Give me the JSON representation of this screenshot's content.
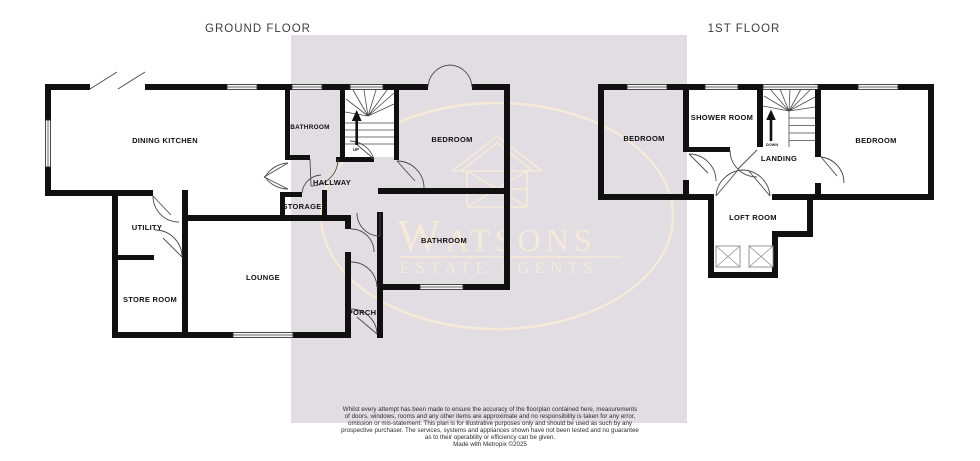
{
  "meta": {
    "wall_color": "#101010",
    "panel_color": "#e2dde2",
    "watermark_color": "#f5ead9",
    "background_color": "#ffffff"
  },
  "watermark": {
    "brand": "Watsons",
    "tagline": "ESTATE AGENTS"
  },
  "floors": {
    "ground": {
      "title": "GROUND FLOOR",
      "dining_kitchen": "DINING KITCHEN",
      "bathroom_top": "BATHROOM",
      "bedroom": "BEDROOM",
      "hallway": "HALLWAY",
      "storage": "STORAGE",
      "utility": "UTILITY",
      "lounge": "LOUNGE",
      "store_room": "STORE ROOM",
      "bathroom_bottom": "BATHROOM",
      "porch": "PORCH",
      "stair_label": "UP"
    },
    "first": {
      "title": "1ST FLOOR",
      "bedroom_left": "BEDROOM",
      "shower_room": "SHOWER ROOM",
      "landing": "LANDING",
      "bedroom_right": "BEDROOM",
      "loft_room": "LOFT ROOM",
      "stair_label": "DOWN"
    }
  },
  "footer": {
    "lines": [
      "Whilst every attempt has been made to ensure the accuracy of the floorplan contained here, measurements",
      "of doors, windows, rooms and any other items are approximate and no responsibility is taken for any error,",
      "omission or mis-statement. This plan is for illustrative purposes only and should be used as such by any",
      "prospective purchaser. The services, systems and appliances shown have not been tested and no guarantee",
      "as to their operability or efficiency can be given."
    ],
    "credit": "Made with Metropix ©2025"
  }
}
